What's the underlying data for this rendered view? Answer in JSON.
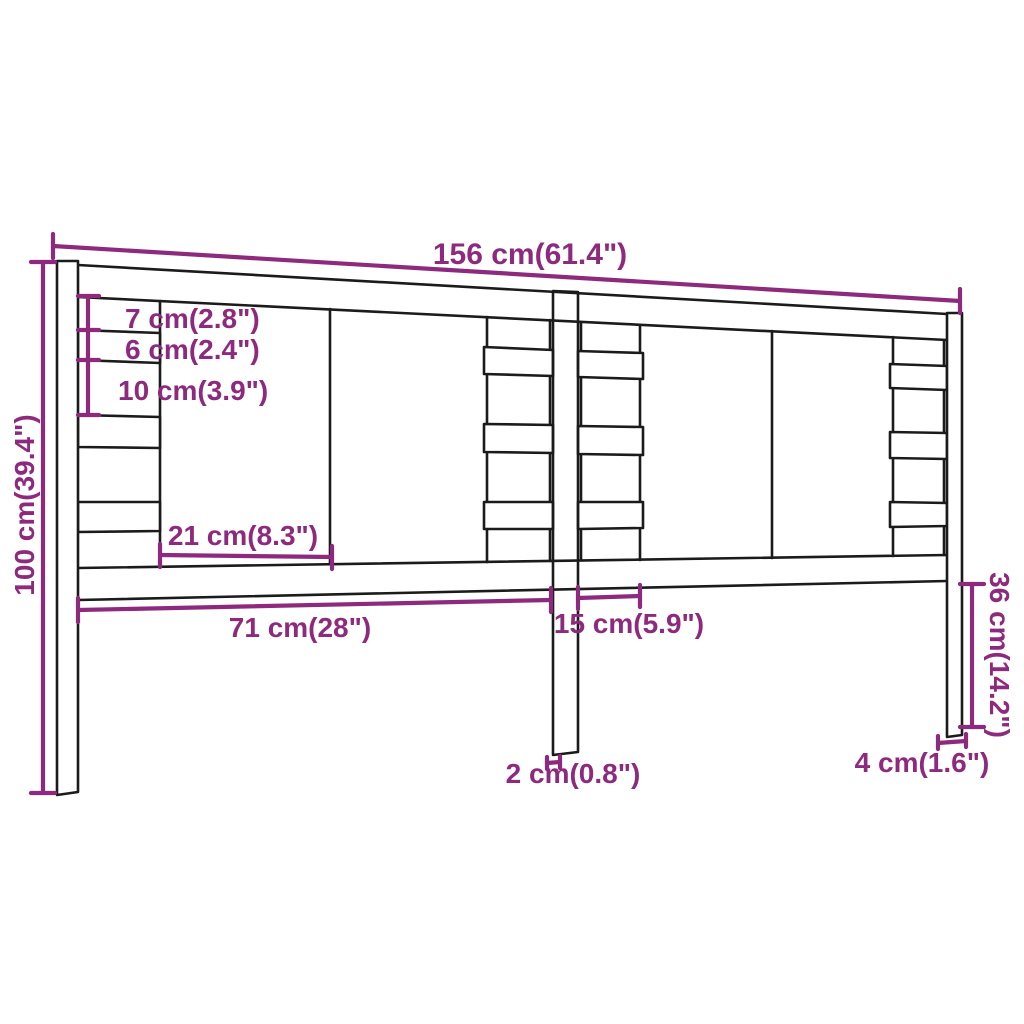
{
  "diagram": {
    "subject": "headboard-dimension-drawing",
    "colors": {
      "dimension_color": "#8E2A7E",
      "outline_color": "#1b1b1b",
      "background": "#ffffff"
    },
    "labels": {
      "total_width": "156 cm(61.4\")",
      "total_height": "100 cm(39.4\")",
      "top_gap": "7 cm(2.8\")",
      "slat_height": "6 cm(2.4\")",
      "mid_gap": "10 cm(3.9\")",
      "board_width": "21 cm(8.3\")",
      "left_panel_width": "71 cm(28\")",
      "slat_column_width": "15 cm(5.9\")",
      "right_leg_height": "36 cm(14.2\")",
      "center_leg_thickness": "2 cm(0.8\")",
      "side_leg_thickness": "4 cm(1.6\")"
    }
  }
}
